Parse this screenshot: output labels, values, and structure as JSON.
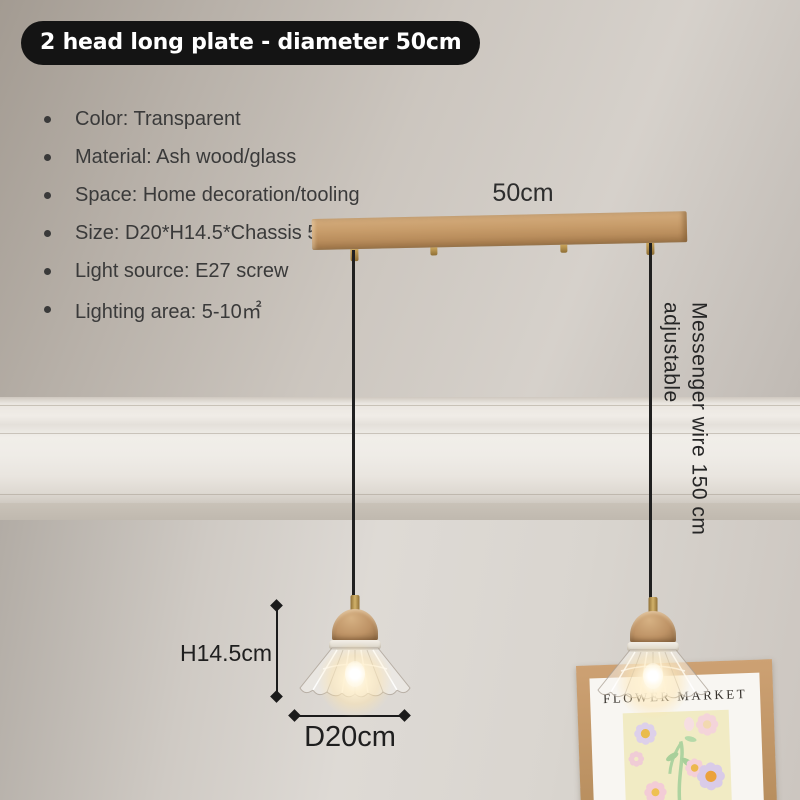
{
  "badge": {
    "label": "2 head long plate - diameter 50cm"
  },
  "specs": {
    "items": [
      "Color: Transparent",
      "Material: Ash wood/glass",
      "Space: Home decoration/tooling",
      "Size: D20*H14.5*Chassis 50cm",
      "Light source: E27 screw",
      "Lighting area: 5-10㎡"
    ]
  },
  "annotations": {
    "plate_width_label": "50cm",
    "height_label": "H14.5cm",
    "diameter_label": "D20cm",
    "wire_label_line1": "Messenger wire 150 cm",
    "wire_label_line2": "adjustable"
  },
  "poster": {
    "title": "FLOWER MARKET"
  },
  "colors": {
    "badge_bg": "#141414",
    "badge_text": "#ffffff",
    "spec_text": "#3a3a3a",
    "annotation_text": "#1f1f1f",
    "wall_upper": "#c6c0b9",
    "wall_lower": "#d9d5cf",
    "wood_plate": "#c09562",
    "brass": "#b08d4f",
    "wire": "#202020",
    "poster_frame": "#c49a6b",
    "poster_panel": "#f1ebc4",
    "bulb_glow": "#ffe9c0"
  }
}
